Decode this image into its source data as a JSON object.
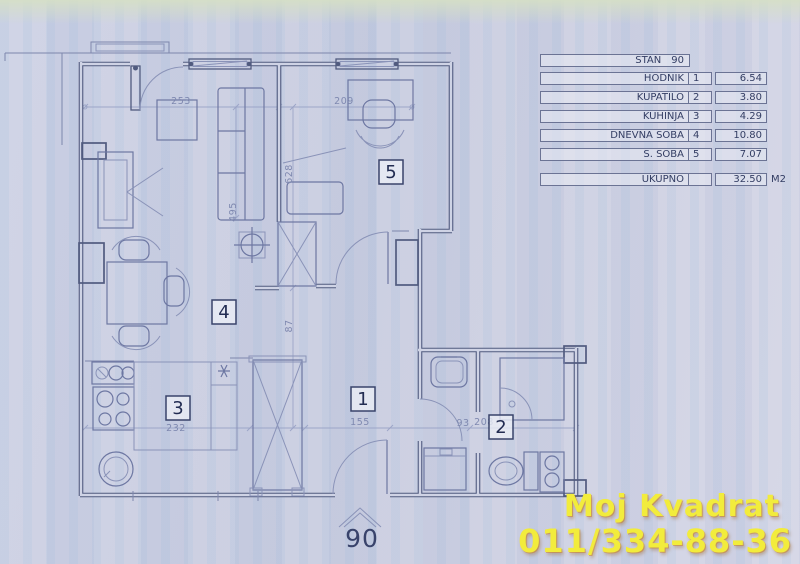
{
  "legend": {
    "title_label": "STAN",
    "title_number": "90",
    "rows": [
      {
        "label": "HODNIK",
        "num": "1",
        "area": "6.54"
      },
      {
        "label": "KUPATILO",
        "num": "2",
        "area": "3.80"
      },
      {
        "label": "KUHINJA",
        "num": "3",
        "area": "4.29"
      },
      {
        "label": "DNEVNA SOBA",
        "num": "4",
        "area": "10.80"
      },
      {
        "label": "S. SOBA",
        "num": "5",
        "area": "7.07"
      }
    ],
    "total_label": "UKUPNO",
    "total_area": "32.50",
    "total_unit": "M2"
  },
  "plan": {
    "rooms": {
      "r1": "1",
      "r2": "2",
      "r3": "3",
      "r4": "4",
      "r5": "5"
    },
    "dims": {
      "living_width": "253",
      "bedroom_width": "209",
      "living_height": "495",
      "bedroom_height": "628",
      "passage": "87",
      "kitchen": "232",
      "hall": "155",
      "bath_small": "93",
      "bath": "208"
    },
    "entrance_number": "90"
  },
  "watermark": {
    "line1": "Moj Kvadrat",
    "line2": "011/334-88-36"
  }
}
